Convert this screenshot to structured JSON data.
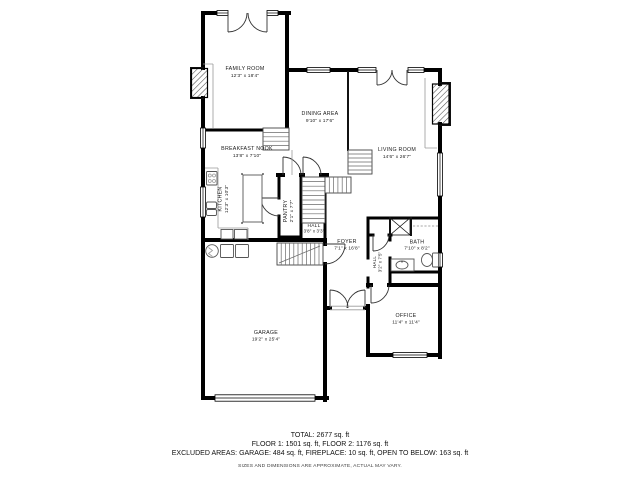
{
  "rooms": [
    {
      "name": "FAMILY ROOM",
      "dims": "12'3\" x 18'4\""
    },
    {
      "name": "DINING AREA",
      "dims": "9'10\" x 17'6\""
    },
    {
      "name": "LIVING ROOM",
      "dims": "14'6\" x 26'7\""
    },
    {
      "name": "BREAKFAST NOOK",
      "dims": "13'8\" x 7'10\""
    },
    {
      "name": "KITCHEN",
      "dims": "12'3\" x 10'3\""
    },
    {
      "name": "PANTRY",
      "dims": "2'1\" x 7'7\""
    },
    {
      "name": "HALL",
      "dims": "3'8\" x 3'3\""
    },
    {
      "name": "FOYER",
      "dims": "7'1\" x 16'8\""
    },
    {
      "name": "HALL",
      "dims": "3'2\" x 7'5\""
    },
    {
      "name": "BATH",
      "dims": "7'10\" x 8'2\""
    },
    {
      "name": "OFFICE",
      "dims": "11'4\" x 11'4\""
    },
    {
      "name": "GARAGE",
      "dims": "19'2\" x 25'4\""
    }
  ],
  "footer": {
    "total": "TOTAL: 2677 sq. ft",
    "floors": "FLOOR 1: 1501 sq. ft, FLOOR 2: 1176 sq. ft",
    "excluded": "EXCLUDED AREAS: GARAGE: 484 sq. ft, FIREPLACE: 10 sq. ft, OPEN TO BELOW: 163 sq. ft",
    "disclaimer": "SIZES AND DIMENSIONS ARE APPROXIMATE, ACTUAL MAY VARY."
  }
}
